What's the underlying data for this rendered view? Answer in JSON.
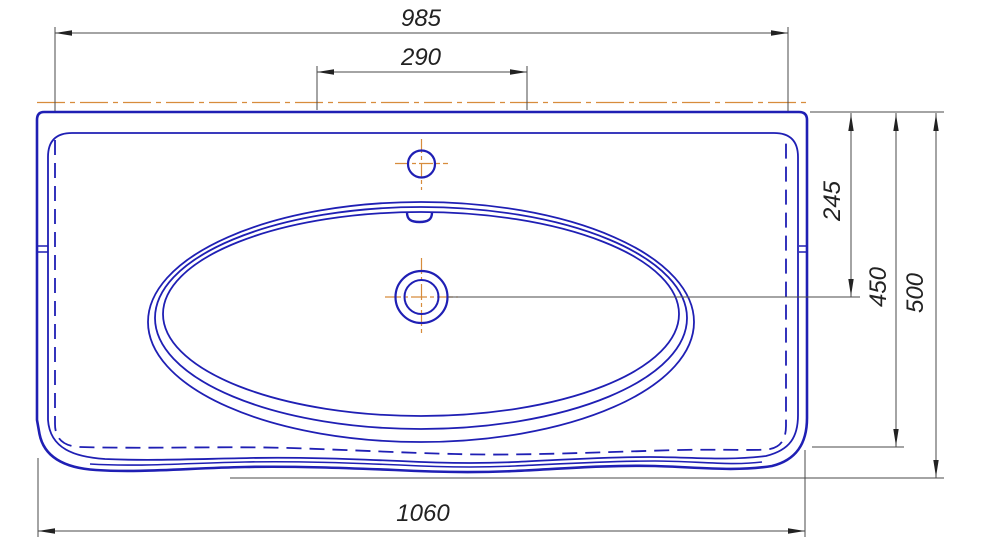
{
  "drawing": {
    "subject": "washbasin-plan-view-technical-drawing",
    "labels": {
      "dim_top_width": "985",
      "dim_faucet_span": "290",
      "dim_drain_offset": "245",
      "dim_body_depth": "450",
      "dim_overall_depth": "500",
      "dim_overall_width": "1060"
    },
    "colors": {
      "outline": "#1f1fb4",
      "centerline": "#d78c3c",
      "dim_line": "#4a4a4a",
      "dim_text": "#222222"
    }
  }
}
